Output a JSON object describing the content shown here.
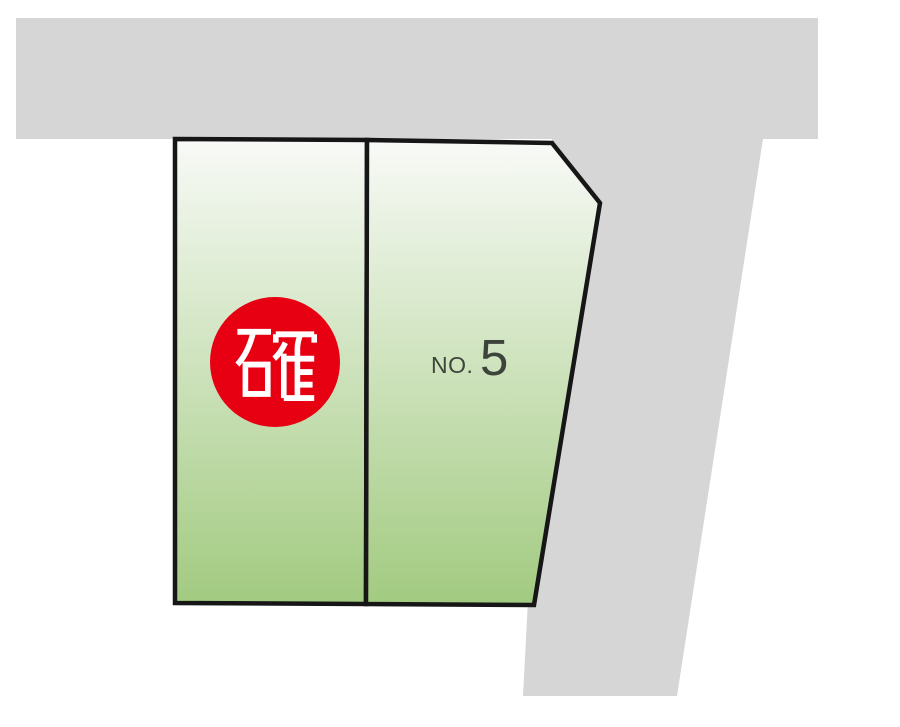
{
  "page": {
    "background_color": "#ffffff",
    "description_text": ""
  },
  "diagram": {
    "type": "land-plot-map",
    "road_color": "#d6d6d6",
    "outline_color": "#161616",
    "parcel_fill_top": "#f8faf7",
    "parcel_fill_bottom": "#a2ca80",
    "parcels": [
      {
        "id": "left-lot",
        "badge": "確",
        "badge_color": "#e60012",
        "badge_text_color": "#ffffff"
      },
      {
        "id": "right-lot",
        "label_prefix": "NO.",
        "label_number": "5",
        "label_color": "#3c443c"
      }
    ]
  }
}
